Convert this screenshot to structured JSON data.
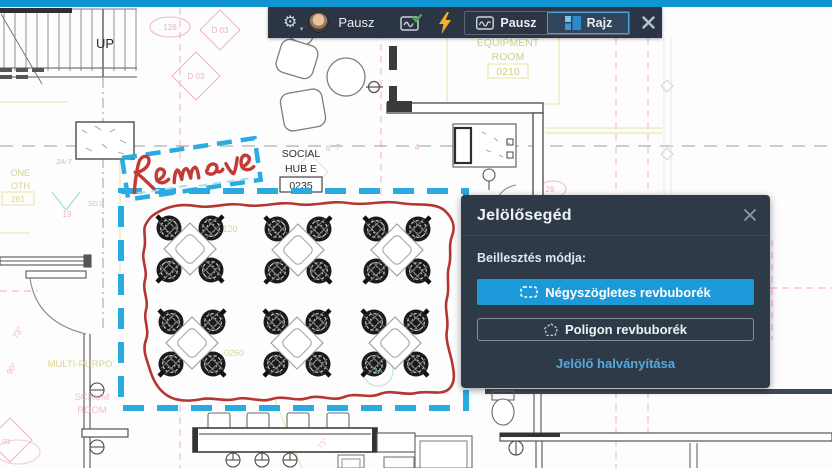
{
  "colors": {
    "accent_blue": "#1b99d8",
    "selection_cyan": "#29abe2",
    "ink_red": "#b43531",
    "toolbar_bg": "#2b3544",
    "panel_bg": "#2f3a49",
    "top_strip": "#1095d3",
    "link_blue": "#55a9de",
    "lightning_yellow": "#f0b429",
    "check_green": "#3fae49"
  },
  "toolbar": {
    "user_name": "Pausz",
    "pausz_button": "Pausz",
    "rajz_button": "Rajz",
    "icons": [
      "gear-icon",
      "avatar",
      "snapshot-check-icon",
      "lightning-icon",
      "close-icon"
    ]
  },
  "panel": {
    "title": "Jelölősegéd",
    "insert_mode_label": "Beillesztés módja:",
    "rect_bubble_button": "Négyszögletes revbuborék",
    "polygon_bubble_button": "Poligon revbuborék",
    "fade_link": "Jelölő halványítása"
  },
  "markup": {
    "remove_label": "Remove"
  },
  "plan": {
    "up": "UP",
    "social": "SOCIAL",
    "hub_e": "HUB E",
    "social_num": "0235",
    "equipment": "EQUIPMENT",
    "room": "ROOM",
    "equipment_num": "0210",
    "d03": "D 03",
    "n126": "126",
    "n120": "120",
    "n0260": "0260",
    "n19": "19",
    "n26": "26",
    "sg1": "SG1",
    "n6": "6",
    "n7": "7",
    "n4": "4",
    "a27": "2A-7",
    "a2": "2A",
    "multi": "MULTI-PURPO",
    "scrum": "SCRUM",
    "scrum_room": "ROOM",
    "ph1": "ONE",
    "ph2": "OTH",
    "ph3": "261",
    "deg73": "73°",
    "deg90": "90°",
    "n03": "03"
  }
}
